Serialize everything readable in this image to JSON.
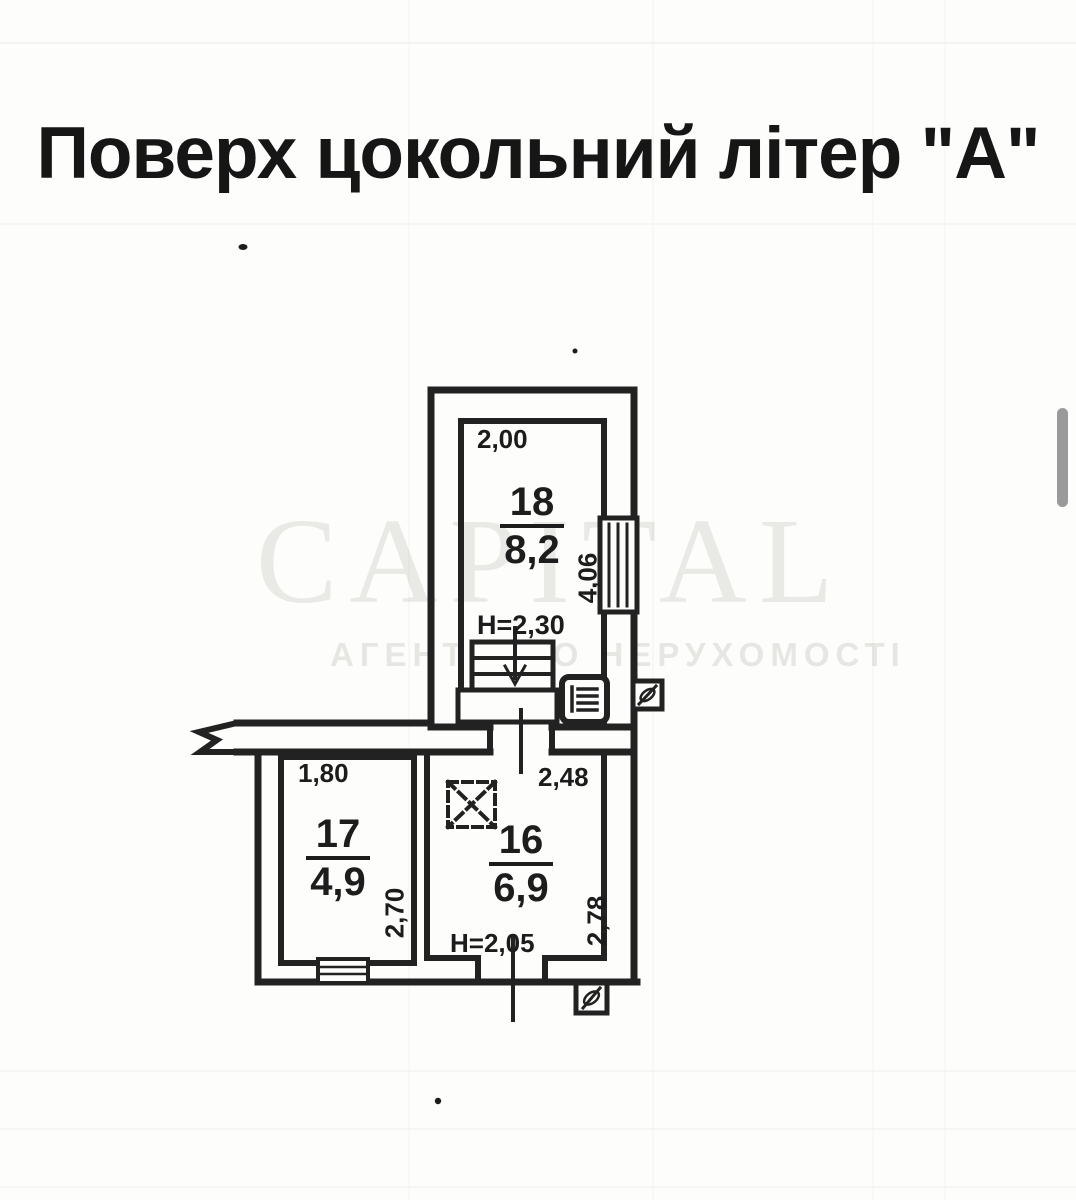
{
  "title": "Поверх цокольний літер \"А\"",
  "watermark": {
    "brand": "CAPITAL",
    "subtitle": "АГЕНТСТВО НЕРУХОМОСТІ"
  },
  "rooms": {
    "r18": {
      "number": "18",
      "area": "8,2",
      "width": "2,00",
      "height": "4,06",
      "clearance": "Н=2,30"
    },
    "r17": {
      "number": "17",
      "area": "4,9",
      "width": "1,80",
      "height": "2,70"
    },
    "r16": {
      "number": "16",
      "area": "6,9",
      "width": "2,48",
      "height": "2,78",
      "clearance": "Н=2,05"
    }
  },
  "symbols": {
    "stairs": "stairs-down-arrow",
    "panel": "electrical-panel-icon",
    "vent_upper": "vent-riser-icon",
    "vent_lower": "vent-riser-icon",
    "shaft": "dashed-shaft-x",
    "windows": "window-hatch",
    "wall_break": "wall-break-zigzag"
  },
  "colors": {
    "ink": "#222222",
    "paper": "#fdfdfb",
    "watermark": "rgba(75,75,68,0.12)",
    "scrollbar": "#9a9a9a"
  }
}
